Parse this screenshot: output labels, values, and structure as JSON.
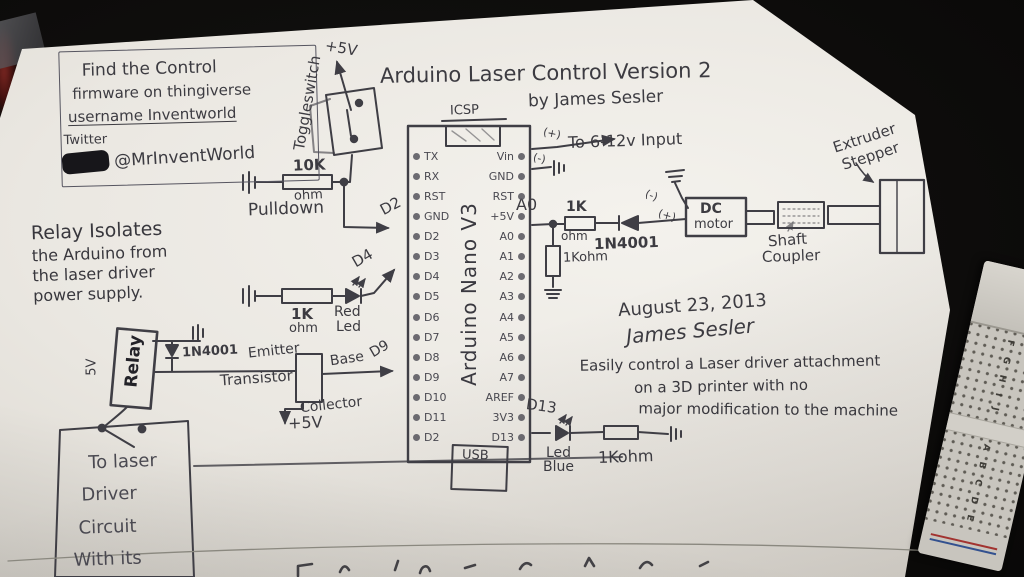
{
  "scene": {
    "background_color": "#0a0908",
    "paper_color": "#eae7e1",
    "ink_color": "#3c3b41"
  },
  "header": {
    "title": "Arduino Laser Control Version 2",
    "byline": "by James Sesler"
  },
  "info_box": {
    "line1": "Find the Control",
    "line2": "firmware on thingiverse",
    "line3": "username Inventworld",
    "twitter_label": "Twitter",
    "twitter_handle": "@MrInventWorld"
  },
  "notes": {
    "relay_note_lines": [
      "Relay Isolates",
      "the Arduino from",
      "the laser driver",
      "power supply."
    ],
    "date": "August 23, 2013",
    "signature": "James Sesler",
    "description_lines": [
      "Easily control a Laser driver attachment",
      "on a 3D printer with no",
      "major modification to the machine"
    ]
  },
  "arduino": {
    "center_label": "Arduino Nano V3",
    "icsp_label": "ICSP",
    "usb_label": "USB",
    "left_pins": [
      "TX",
      "RX",
      "RST",
      "GND",
      "D2",
      "D3",
      "D4",
      "D5",
      "D6",
      "D7",
      "D8",
      "D9",
      "D10",
      "D11",
      "D2"
    ],
    "right_pins": [
      "Vin",
      "GND",
      "RST",
      "+5V",
      "A0",
      "A1",
      "A2",
      "A3",
      "A4",
      "A5",
      "A6",
      "A7",
      "AREF",
      "3V3",
      "D13"
    ]
  },
  "power": {
    "toggle_switch_label": "Toggleswitch",
    "plus5v_top": "+5V",
    "pulldown_value": "10K",
    "pulldown_unit": "ohm",
    "pulldown_label": "Pulldown",
    "d2_wire_label": "D2",
    "vin_input_label": "To 6-12v Input",
    "vin_plus": "(+)",
    "gnd_minus": "(-)"
  },
  "red_led_branch": {
    "resistor_value": "1K",
    "resistor_unit": "ohm",
    "led_line1": "Red",
    "led_line2": "Led",
    "wire_label": "D4"
  },
  "relay_branch": {
    "relay_label": "Relay",
    "relay_voltage": "5V",
    "flyback_diode": "1N4001",
    "emitter": "Emitter",
    "transistor": "Transistor",
    "base": "Base",
    "collector": "Collector",
    "plus5v": "+5V",
    "wire_label": "D9",
    "laser_box_lines": [
      "To laser",
      "Driver",
      "Circuit",
      "With its"
    ]
  },
  "motor_branch": {
    "a0_label": "A0",
    "series_resistor_value": "1K",
    "series_resistor_unit": "ohm",
    "series_diode": "1N4001",
    "shunt_resistor": "1Kohm",
    "motor_minus": "(-)",
    "motor_plus": "(+)",
    "dc_motor_line1": "DC",
    "dc_motor_line2": "motor",
    "shaft_coupler_line1": "Shaft",
    "shaft_coupler_line2": "Coupler",
    "stepper_line1": "Extruder",
    "stepper_line2": "Stepper"
  },
  "blue_led_branch": {
    "wire_label": "D13",
    "led_line1": "Led",
    "led_line2": "Blue",
    "resistor": "1Kohm"
  },
  "breadboard": {
    "columns_group1": "F G H I J",
    "columns_group2": "A B C D E"
  }
}
